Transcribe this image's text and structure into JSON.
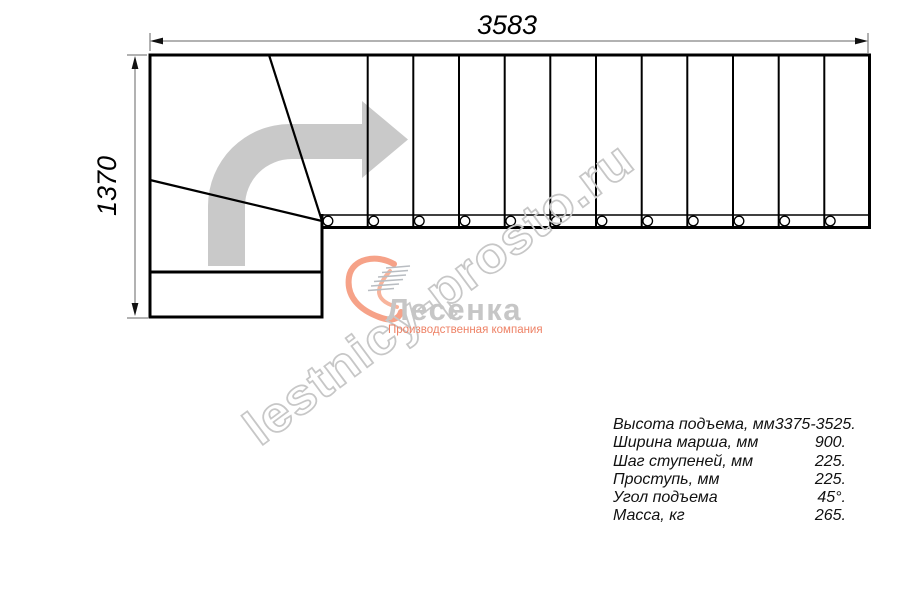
{
  "drawing": {
    "title": "staircase-plan-view",
    "steps_count": 12,
    "line_color": "#000000",
    "dimension_line_color": "#666666",
    "direction_arrow_color": "#c9c9c9",
    "dimensions": {
      "width_mm": "3583",
      "height_mm": "1370"
    }
  },
  "specs": {
    "rows": [
      {
        "label": "Высота подъема, мм",
        "value": "3375-3525."
      },
      {
        "label": "Ширина марша, мм",
        "value": "900."
      },
      {
        "label": "Шаг ступеней, мм",
        "value": "225."
      },
      {
        "label": "Проступь, мм",
        "value": "225."
      },
      {
        "label": "Угол подъема",
        "value": "45°."
      },
      {
        "label": "Масса, кг",
        "value": "265."
      }
    ]
  },
  "watermark": {
    "text": "lestnicy-prosto.ru",
    "color": "#c7c7c7"
  },
  "logo": {
    "name": "Лесенка",
    "tagline": "Производственная компания",
    "accent_color": "#f6a288",
    "text_color": "#c6c6c6"
  }
}
